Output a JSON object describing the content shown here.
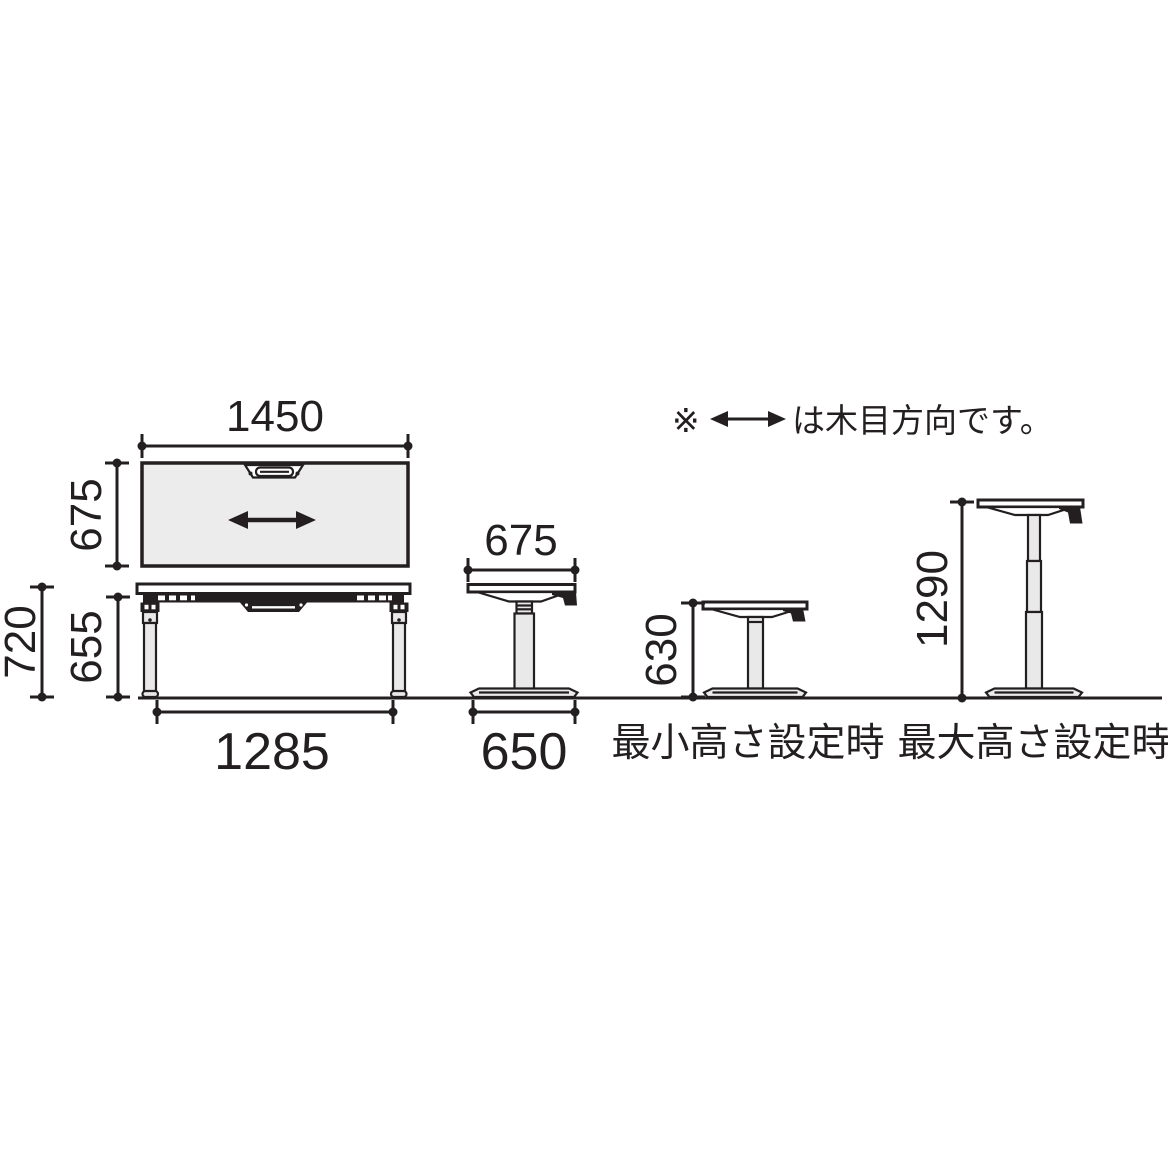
{
  "note": {
    "marker": "※",
    "text": "は木目方向です。"
  },
  "views": {
    "top": {
      "width": "1450",
      "depth": "675"
    },
    "front": {
      "overall_height": "720",
      "clearance_height": "655",
      "leg_span": "1285"
    },
    "side": {
      "top_depth": "675",
      "base_depth": "650"
    },
    "min": {
      "height": "630",
      "caption": "最小高さ設定時"
    },
    "max": {
      "height": "1290",
      "caption": "最大高さ設定時"
    }
  },
  "colors": {
    "line": "#231f20",
    "tabletop_fill": "#ececec",
    "leg_fill": "#e9e9e9",
    "background": "#ffffff"
  },
  "icons": {
    "grain_arrow": "double-headed-arrow",
    "note_arrow": "double-headed-arrow"
  }
}
